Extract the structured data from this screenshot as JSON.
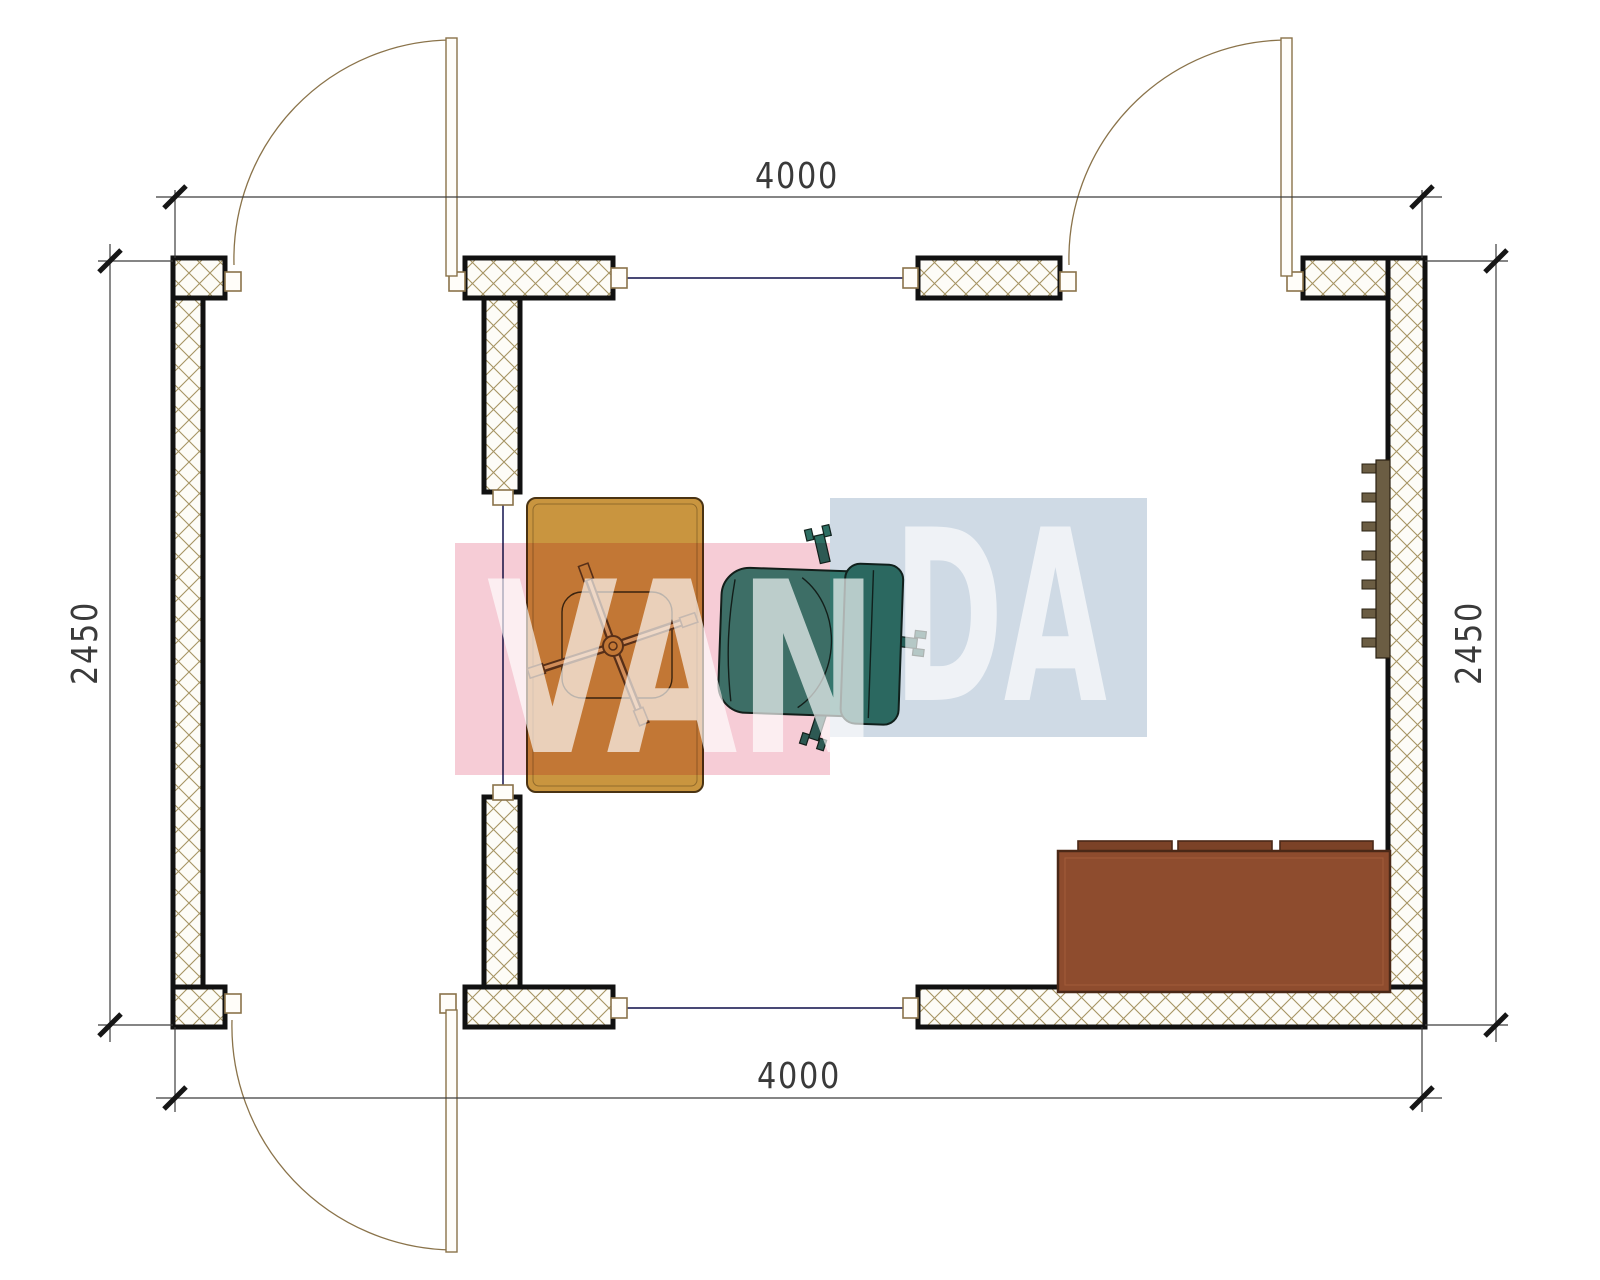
{
  "dimensions": {
    "top": "4000",
    "bottom": "4000",
    "left": "2450",
    "right": "2450"
  },
  "watermark": {
    "text_left": "VAN",
    "text_right": "DA",
    "pink": "#f6ccd6",
    "blue": "#cfdae5",
    "letter": "#ffffff"
  },
  "colors": {
    "wall_outline": "#111111",
    "hatch_line": "#a69463",
    "hatch_bg": "#fdfcf7",
    "frame": "#8a734a",
    "glass": "#2f2f63",
    "dim_text": "#3a3a3a",
    "desk": "#c9953f",
    "desk_edge": "#4a3313",
    "chair_base_line": "#5a3a1c",
    "chair_seat": "#3f8a79",
    "chair_back": "#35796b",
    "chair_prong": "#2e6f63",
    "sofa": "#8e4c2e",
    "sofa_cushion": "#7b4227",
    "sofa_edge": "#4a2817",
    "radiator": "#6b5d43"
  }
}
